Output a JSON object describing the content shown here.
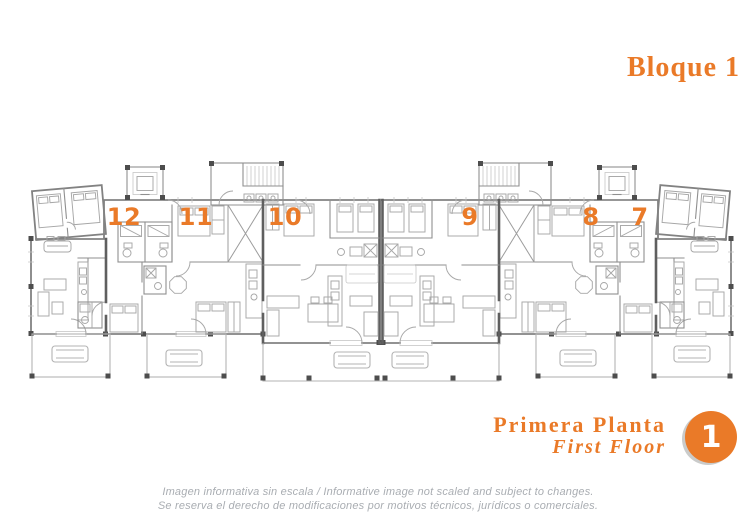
{
  "header": {
    "title": "Bloque 1"
  },
  "plan": {
    "units": [
      {
        "label": "12"
      },
      {
        "label": "11"
      },
      {
        "label": "10"
      },
      {
        "label": "9"
      },
      {
        "label": "8"
      },
      {
        "label": "7"
      }
    ]
  },
  "floor": {
    "name_es": "Primera Planta",
    "name_en": "First Floor",
    "number": "1"
  },
  "disclaimer": {
    "line1": "Imagen informativa sin escala /  Informative image not scaled and subject to changes.",
    "line2": "Se reserva el derecho de modificaciones por motivos técnicos, jurídicos o comerciales."
  },
  "colors": {
    "accent": "#EA7A28",
    "plan_line": "#8a8a8a",
    "muted_text": "#A9ADB2"
  }
}
